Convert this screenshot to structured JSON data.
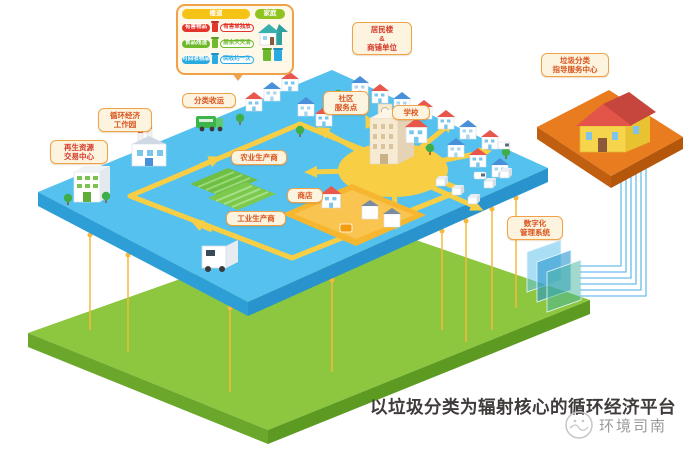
{
  "title": "以垃圾分类为辐射核心的循环经济平台",
  "watermark": "环境司南",
  "colors": {
    "blue_platform": "#55c1ef",
    "blue_platform_side": "#2d9fd6",
    "green_platform": "#8dc63f",
    "green_platform_side": "#64a023",
    "orange_platform": "#e87c1e",
    "road_yellow": "#f8cf44",
    "label_bg": "#fdf4df",
    "label_border": "#f0a24a",
    "label_text": "#d9541e",
    "pin_yellow": "#f5b83d",
    "data_line_blue": "#5bb7e8",
    "caption_text": "#3f3b3a"
  },
  "legend": {
    "corridor_header": "楼道",
    "home_header": "家庭",
    "rows": [
      {
        "name": "有害物品",
        "tag": "有害单独放"
      },
      {
        "name": "食品残渣",
        "tag": "厨余天天清"
      },
      {
        "name": "可回收物品",
        "tag": "回收约一次"
      }
    ]
  },
  "map_labels": {
    "residential": {
      "line1": "居民楼",
      "line2": "&",
      "line3": "商铺单位"
    },
    "collection": {
      "line1": "分类收运"
    },
    "eco_park": {
      "line1": "循环经济",
      "line2": "工作园"
    },
    "trade_center": {
      "line1": "再生资源",
      "line2": "交易中心"
    },
    "community": {
      "line1": "社区",
      "line2": "服务点"
    },
    "school": {
      "line1": "学校"
    },
    "guidance": {
      "line1": "垃圾分类",
      "line2": "指导服务中心"
    },
    "digital": {
      "line1": "数字化",
      "line2": "管理系统"
    },
    "agriculture": {
      "line1": "农业生产商"
    },
    "shop": {
      "line1": "商店"
    },
    "industry": {
      "line1": "工业生产商"
    }
  }
}
